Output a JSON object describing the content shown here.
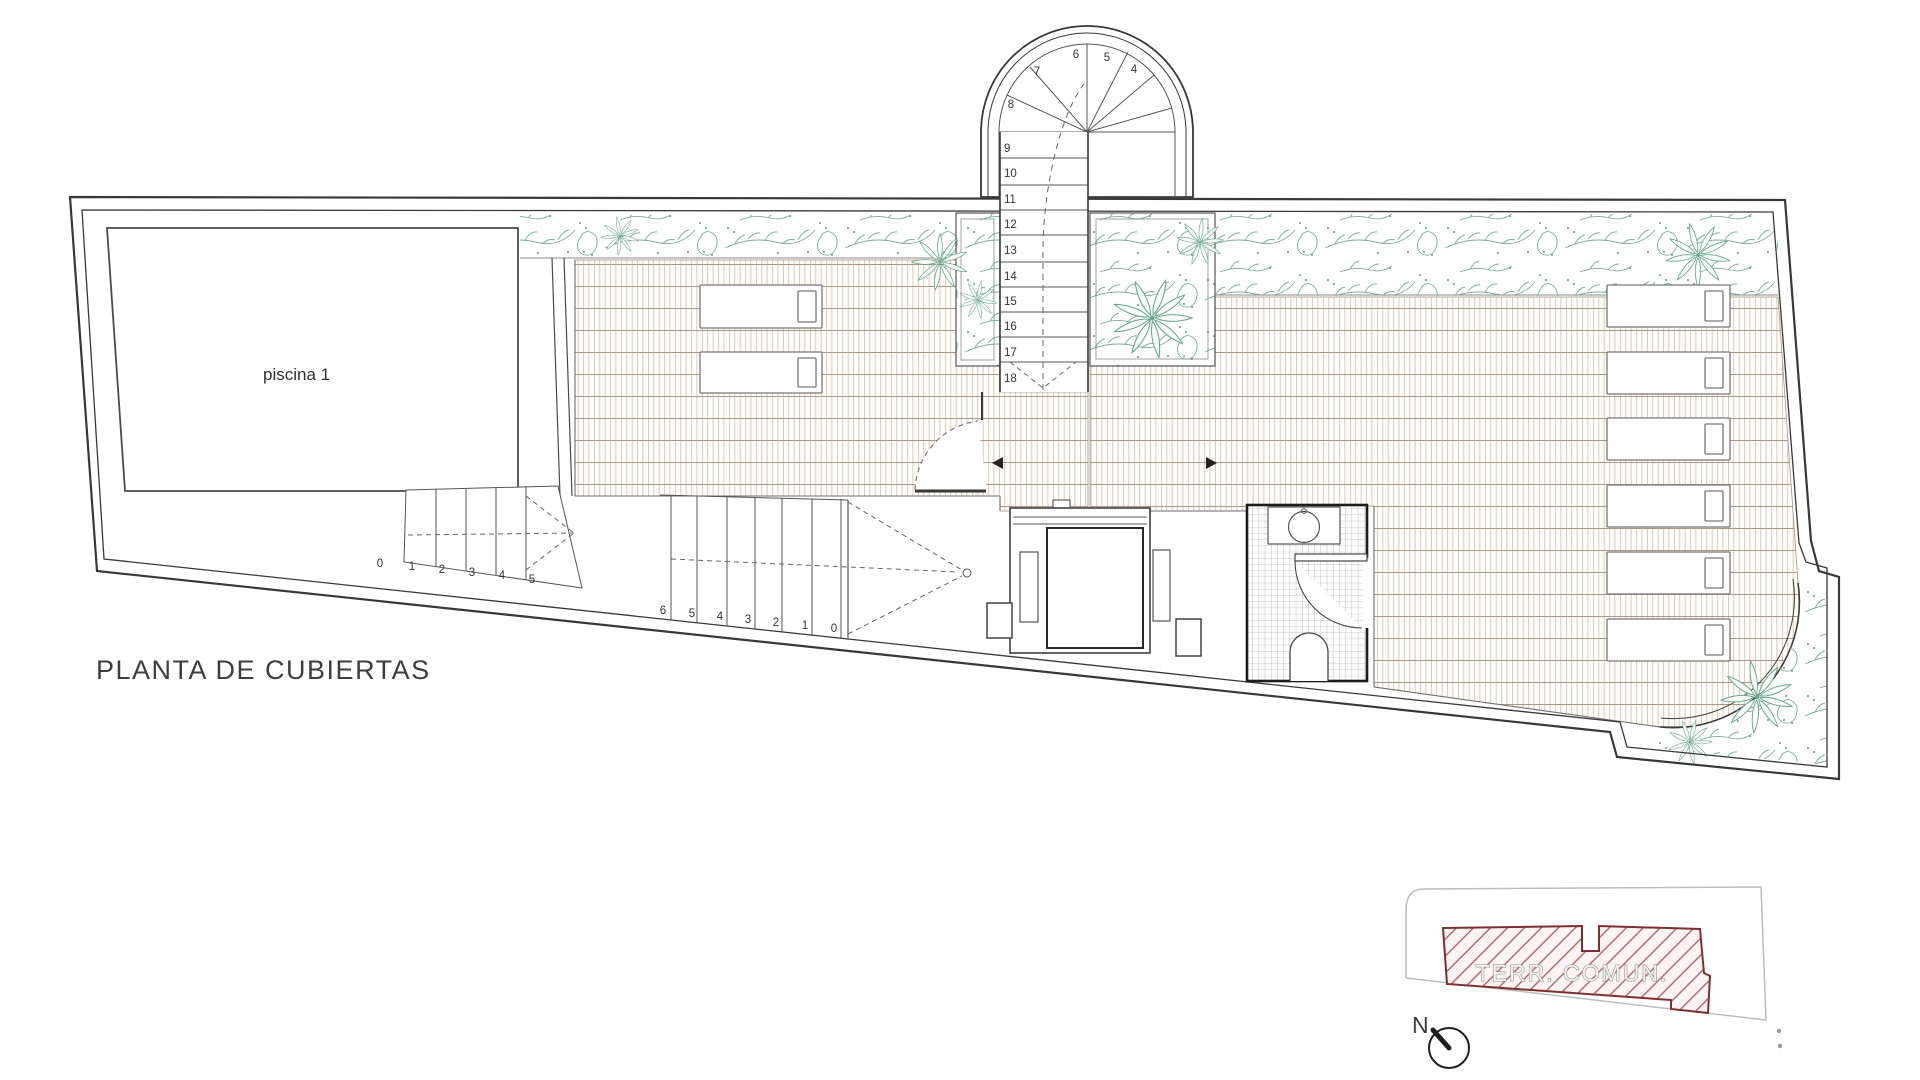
{
  "title": "PLANTA DE CUBIERTAS",
  "pool": {
    "label": "piscina 1"
  },
  "stairs": {
    "tower_winder": [
      "4",
      "5",
      "6",
      "7",
      "8"
    ],
    "tower_flight": [
      "9",
      "10",
      "11",
      "12",
      "13",
      "14",
      "15",
      "16",
      "17",
      "18"
    ],
    "pool_flight": [
      "0",
      "1",
      "2",
      "3",
      "4",
      "5"
    ],
    "terrace_flight": [
      "6",
      "5",
      "4",
      "3",
      "2",
      "1",
      "0"
    ]
  },
  "key_plan": {
    "area_label": "TERR. COMUN.",
    "north_label": "N"
  },
  "colors": {
    "wall_line": "#383838",
    "tile_line_v": "#c4b49e",
    "tile_line_h": "#a09077",
    "plant_green": "#7cae97",
    "hatch_red": "#7c3030",
    "keyplan_gray": "#bdbdbd"
  }
}
